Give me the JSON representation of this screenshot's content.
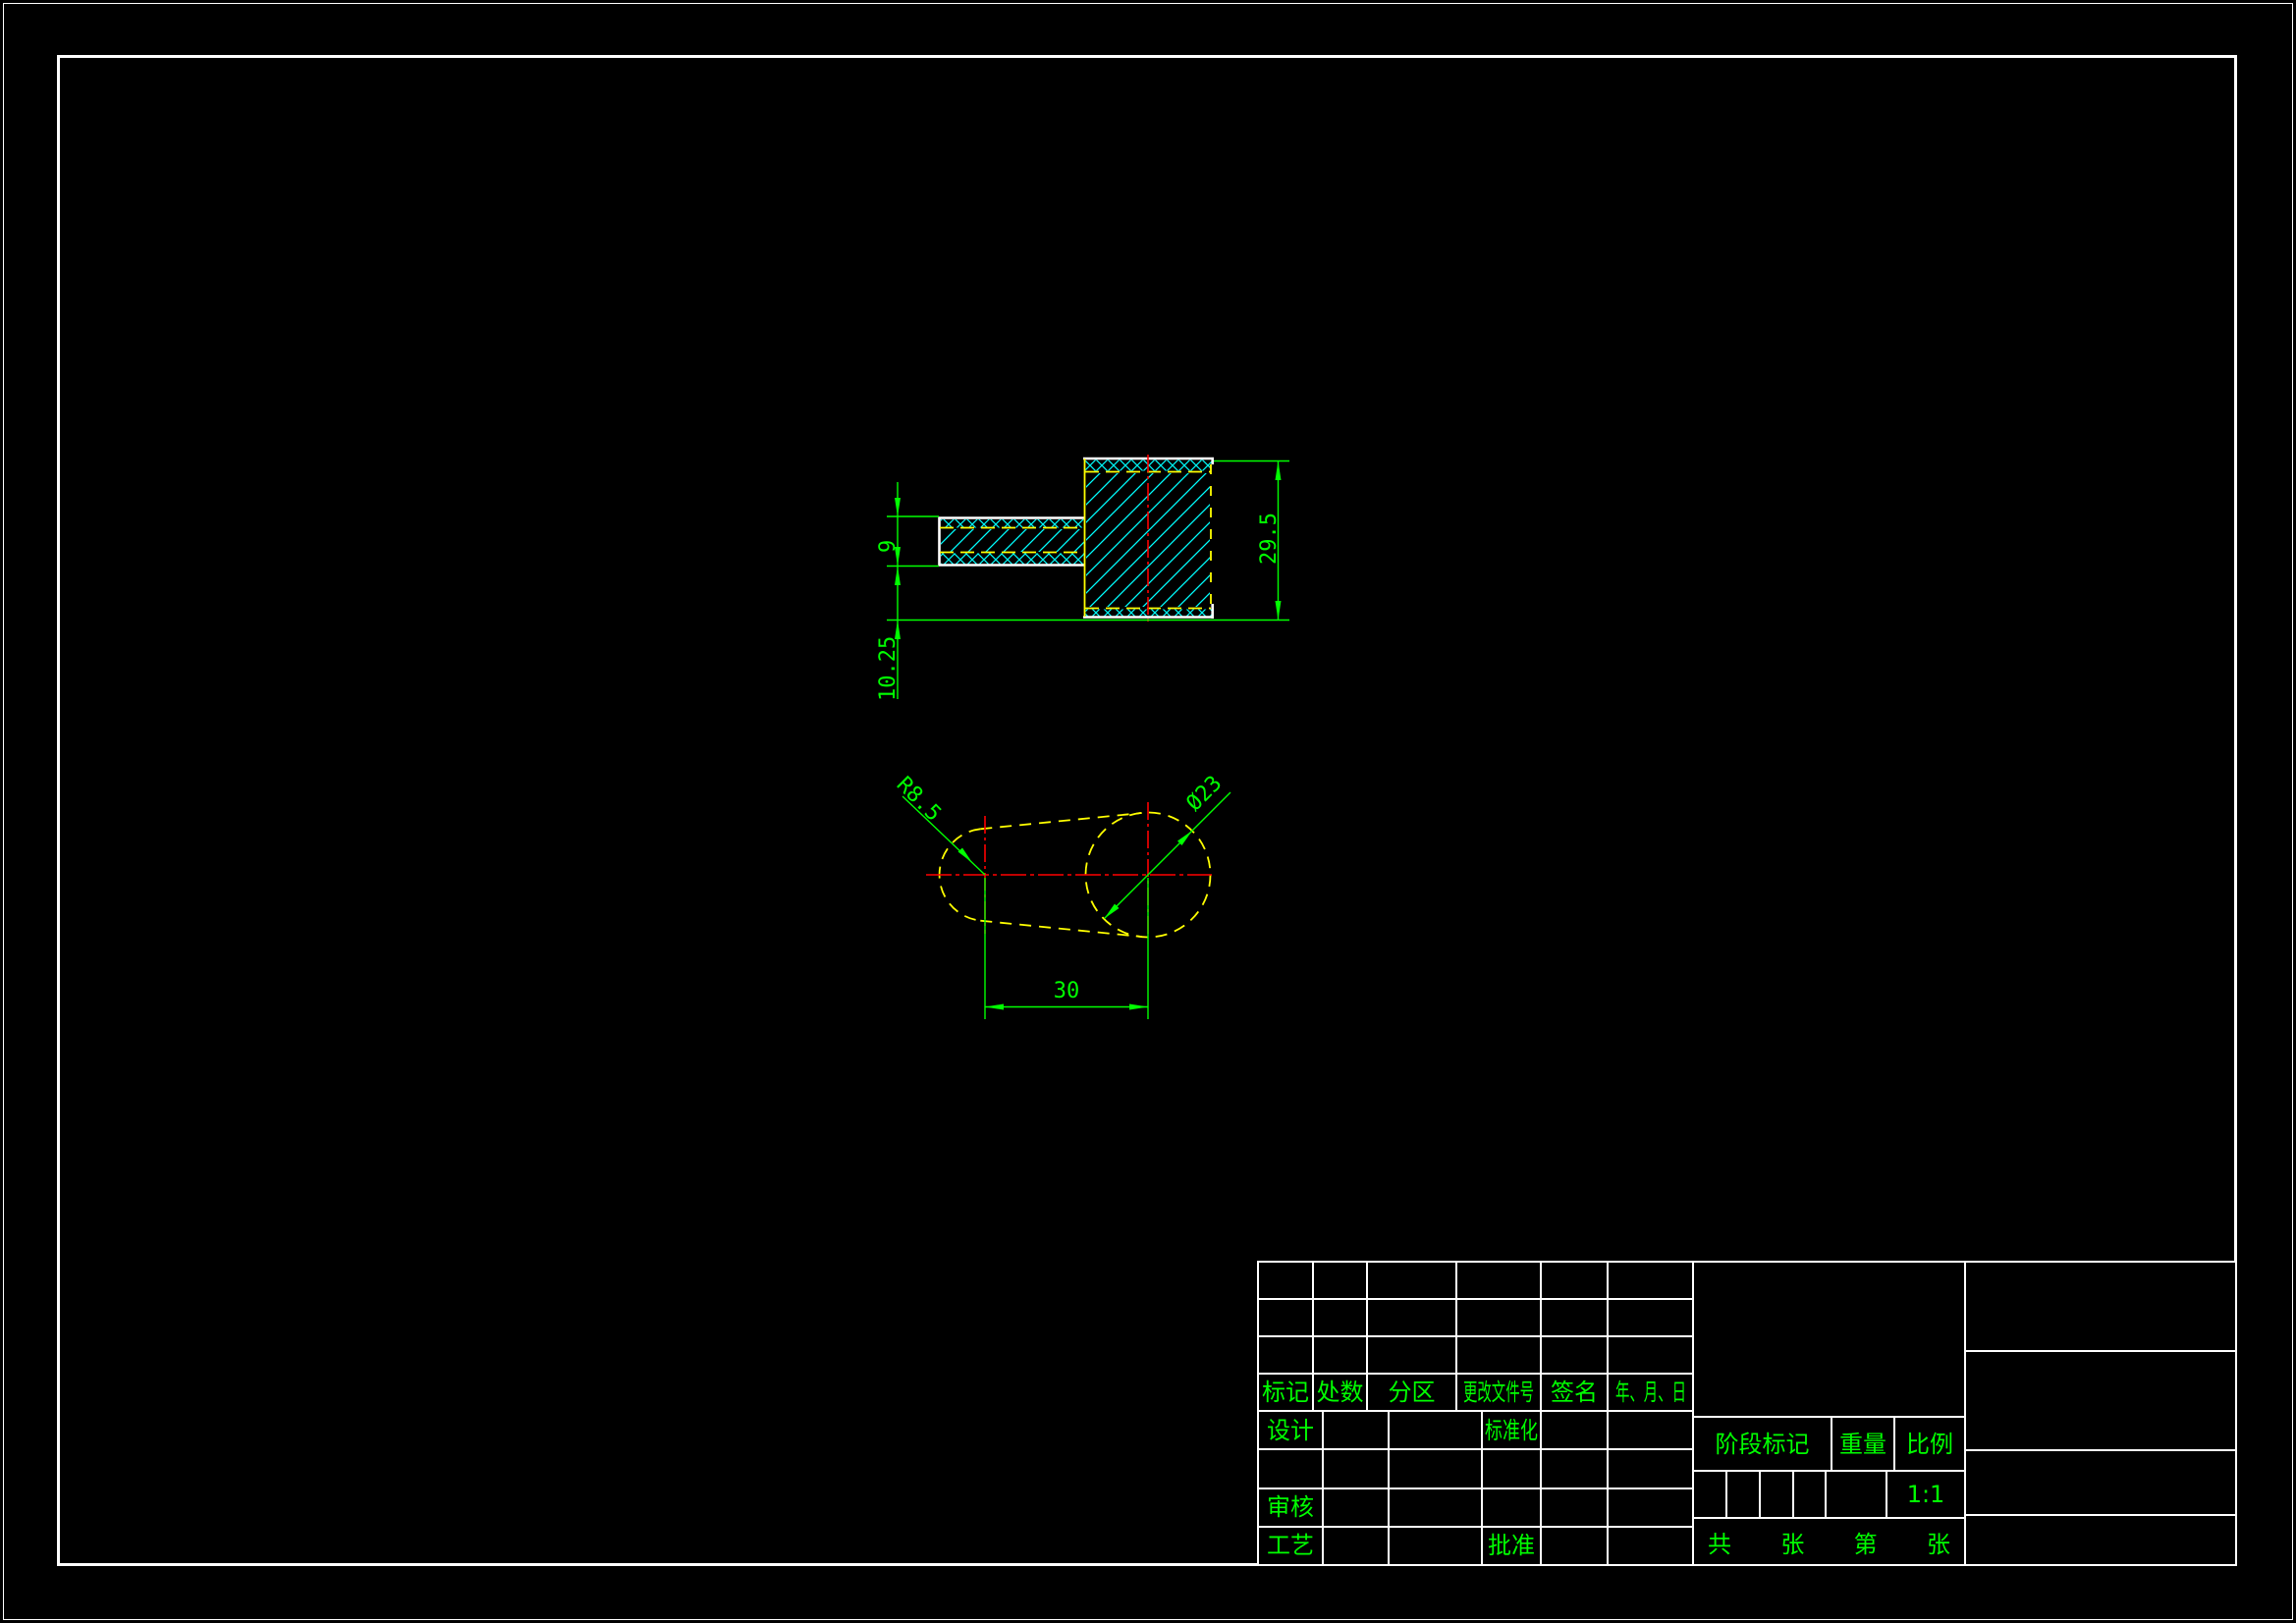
{
  "drawing": {
    "section_view": {
      "dims": {
        "arm_thickness": "9",
        "bottom_offset": "10.25",
        "overall_height": "29.5"
      }
    },
    "plan_view": {
      "dims": {
        "left_radius": "R8.5",
        "hole_diameter": "Ø23",
        "center_distance": "30"
      }
    },
    "colors": {
      "outline": "#ffffff",
      "hatch": "#00ffff",
      "hidden_line": "#ffff00",
      "center_line": "#ff0000",
      "dimension": "#00ff00",
      "background": "#000000"
    }
  },
  "title_block": {
    "revision_row": [
      "标记",
      "处数",
      "分区",
      "更改文件号",
      "签名",
      "年、月、日"
    ],
    "labels": {
      "design": "设计",
      "standardize": "标准化",
      "audit": "审核",
      "process": "工艺",
      "approve": "批准",
      "stage_mark": "阶段标记",
      "weight": "重量",
      "scale": "比例"
    },
    "scale_value": "1:1",
    "sheet_row": [
      "共",
      "张",
      "第",
      "张"
    ]
  }
}
